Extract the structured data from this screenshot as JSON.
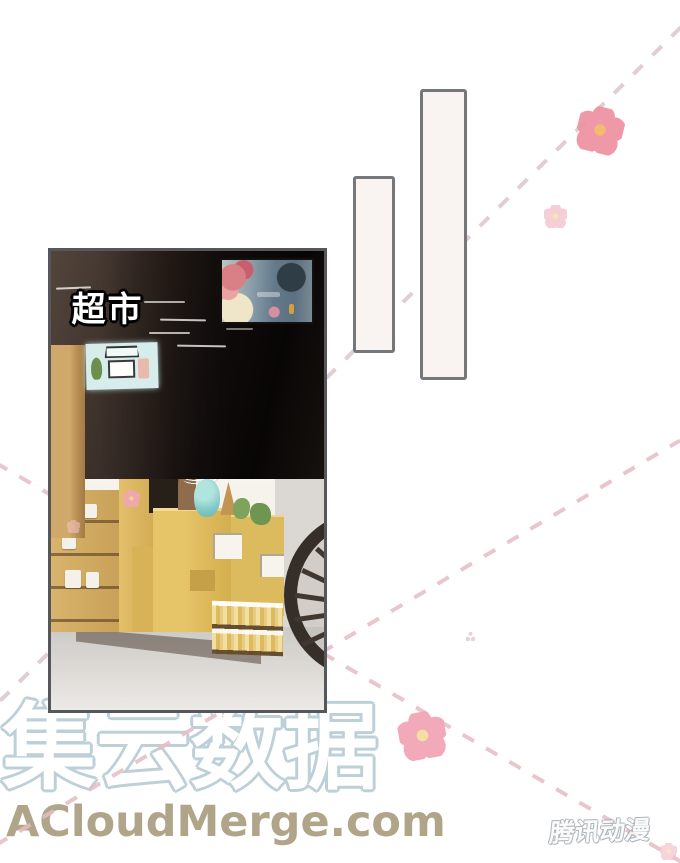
{
  "panel": {
    "label": "超市",
    "description": "supermarket interior photo panel"
  },
  "speech_bubbles": [
    {
      "id": "tall-vertical",
      "text": ""
    },
    {
      "id": "small-vertical",
      "text": ""
    }
  ],
  "watermark": {
    "title": "集云数据",
    "url": "ACloudMerge.com"
  },
  "publisher": {
    "logo_text": "腾讯动漫"
  },
  "decor": {
    "dashed_lines": 3,
    "flowers": 5,
    "icon_names": [
      "flower-icon",
      "dashed-line",
      "sparkle-icon"
    ]
  },
  "colors": {
    "page_bg": "#ffffff",
    "bubble_fill": "#f9f4f2",
    "bubble_border": "#75777b",
    "panel_border": "#56575a",
    "dash_pink": "#e6bcc3",
    "dash_muted": "#d8c2c6",
    "flower_pink": "#f2a6b8",
    "flower_pink_dark": "#ee8f9f",
    "flower_pink_light": "#f4c3cc",
    "flower_core": "#f6dc9e",
    "flower_core_dark": "#f2b45e",
    "wm_outline": "#bdd0d8",
    "url_color": "#a89c7c"
  }
}
